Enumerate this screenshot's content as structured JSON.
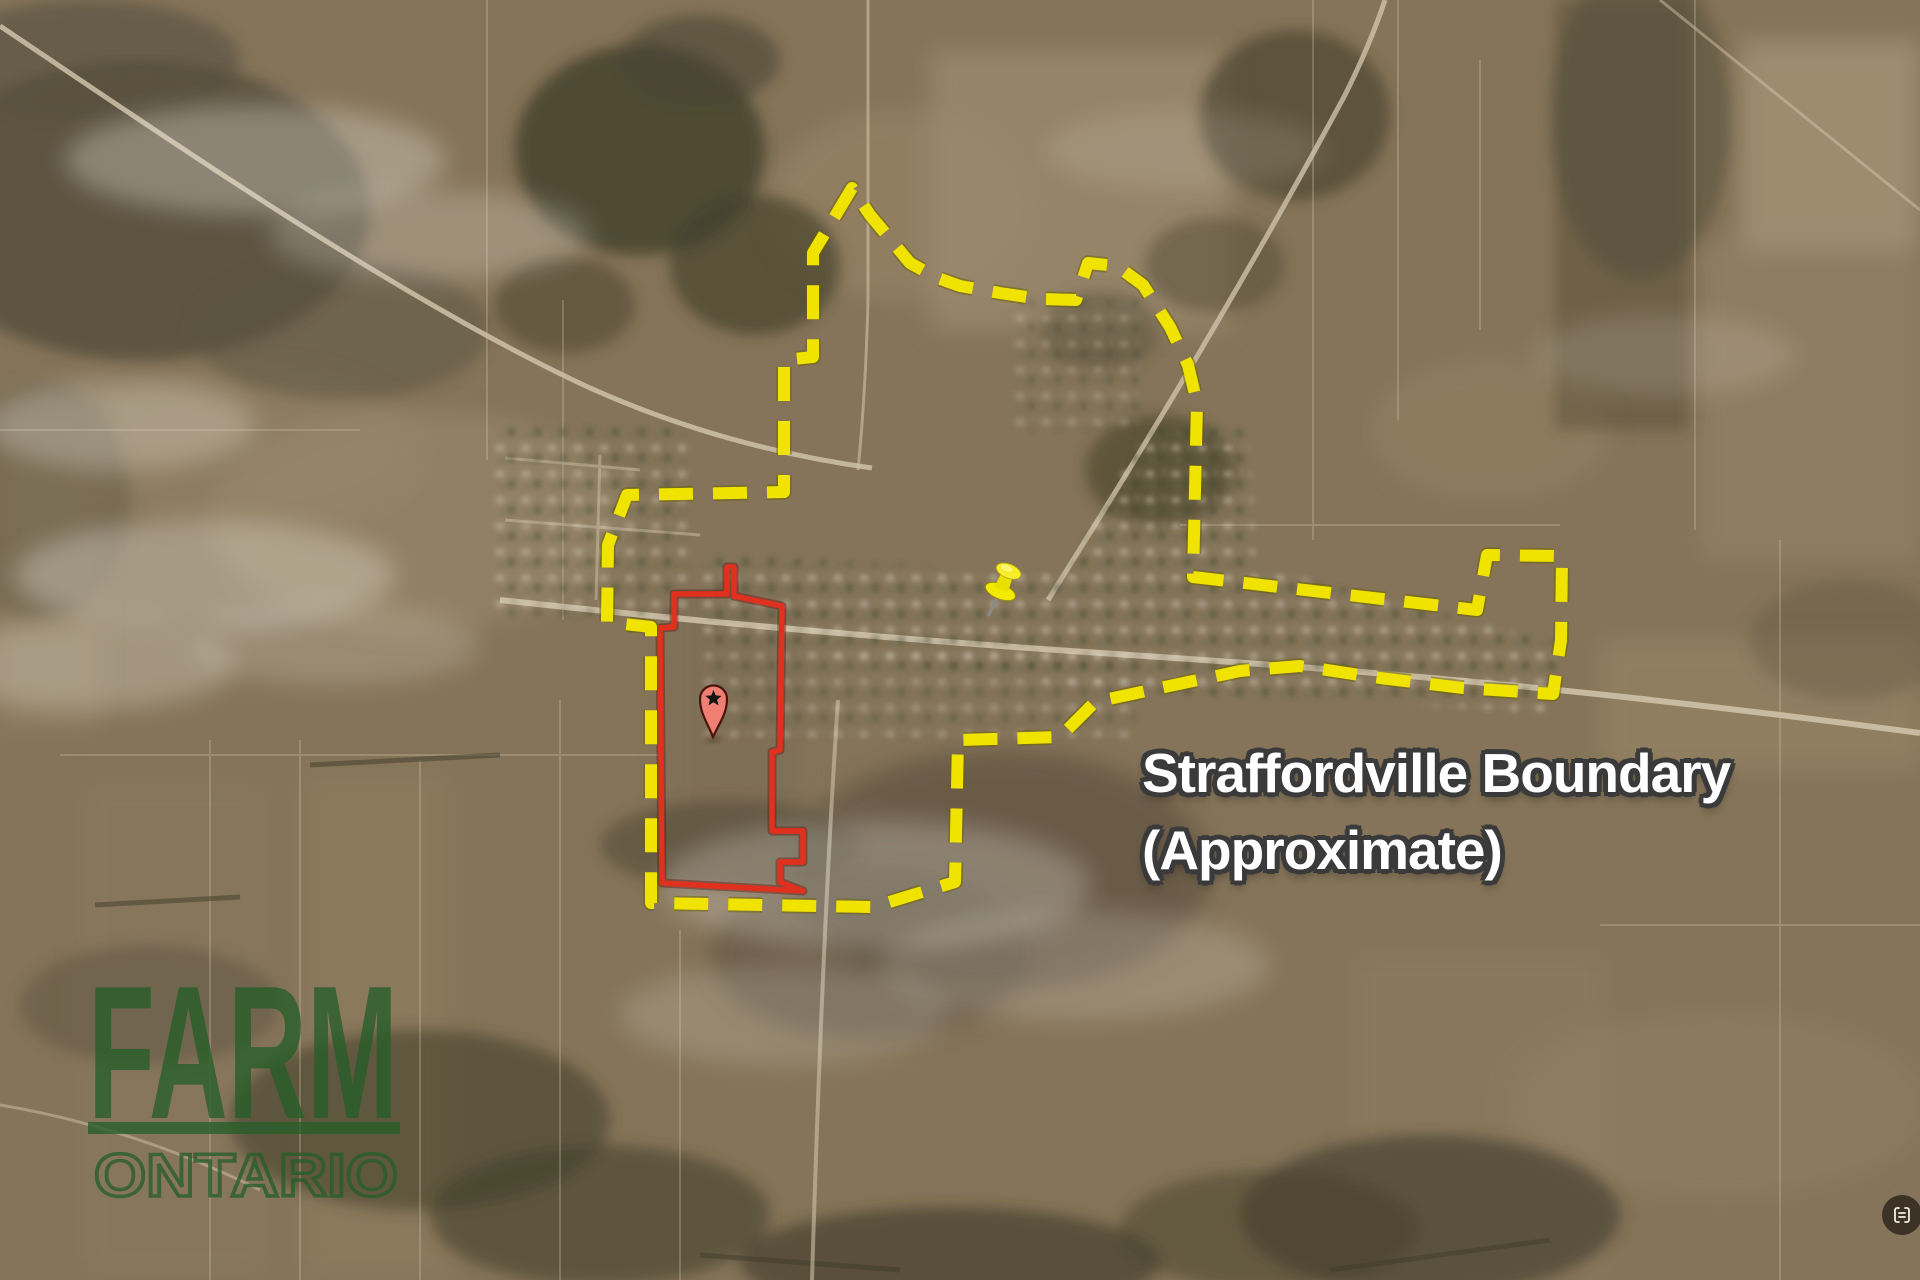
{
  "map": {
    "scene": "aerial satellite view of Straffordville village and surrounding farmland",
    "label": {
      "line1": "Straffordville Boundary",
      "line2": "(Approximate)"
    },
    "watermark": {
      "line1": "FARM",
      "line2": "ONTARIO"
    },
    "boundary": {
      "name": "Straffordville boundary (approximate)",
      "style": "dashed",
      "color": "#f0e300",
      "path_d": "M852 188 L813 253 L813 357 L784 360 L784 492 L627 495 L608 545 L607 622 L651 627 L651 903 L873 907 L955 882 L958 740 L1060 737 L1095 702 L1160 688 L1240 671 L1300 666 L1380 678 L1463 688 L1553 694 L1561 640 L1562 556 L1487 555 L1477 610 L1193 577 L1197 403 L1188 365 L1170 327 L1143 285 L1117 266 L1088 263 L1076 300 L1040 299 L1000 293 L960 286 L935 277 L910 263 L870 215 Z"
    },
    "property": {
      "name": "highlighted property outline",
      "style": "solid",
      "color": "#e0301e",
      "path_d": "M674 594 L727 594 L727 567 L734 567 L734 596 L782 606 L780 750 L772 752 L772 831 L803 831 L803 862 L780 862 L780 882 L803 891 L662 883 L660 628 L674 627 Z"
    },
    "markers": [
      {
        "name": "red-star-pin",
        "x": 713,
        "y": 737
      },
      {
        "name": "yellow-pushpin",
        "x": 990,
        "y": 615
      }
    ],
    "corner_icon": "scan-icon",
    "colors": {
      "boundary_yellow": "#f0e300",
      "property_red": "#e0301e",
      "watermark_green": "#265e28",
      "label_text": "#ffffff",
      "label_outline": "#3a3a3a"
    }
  }
}
